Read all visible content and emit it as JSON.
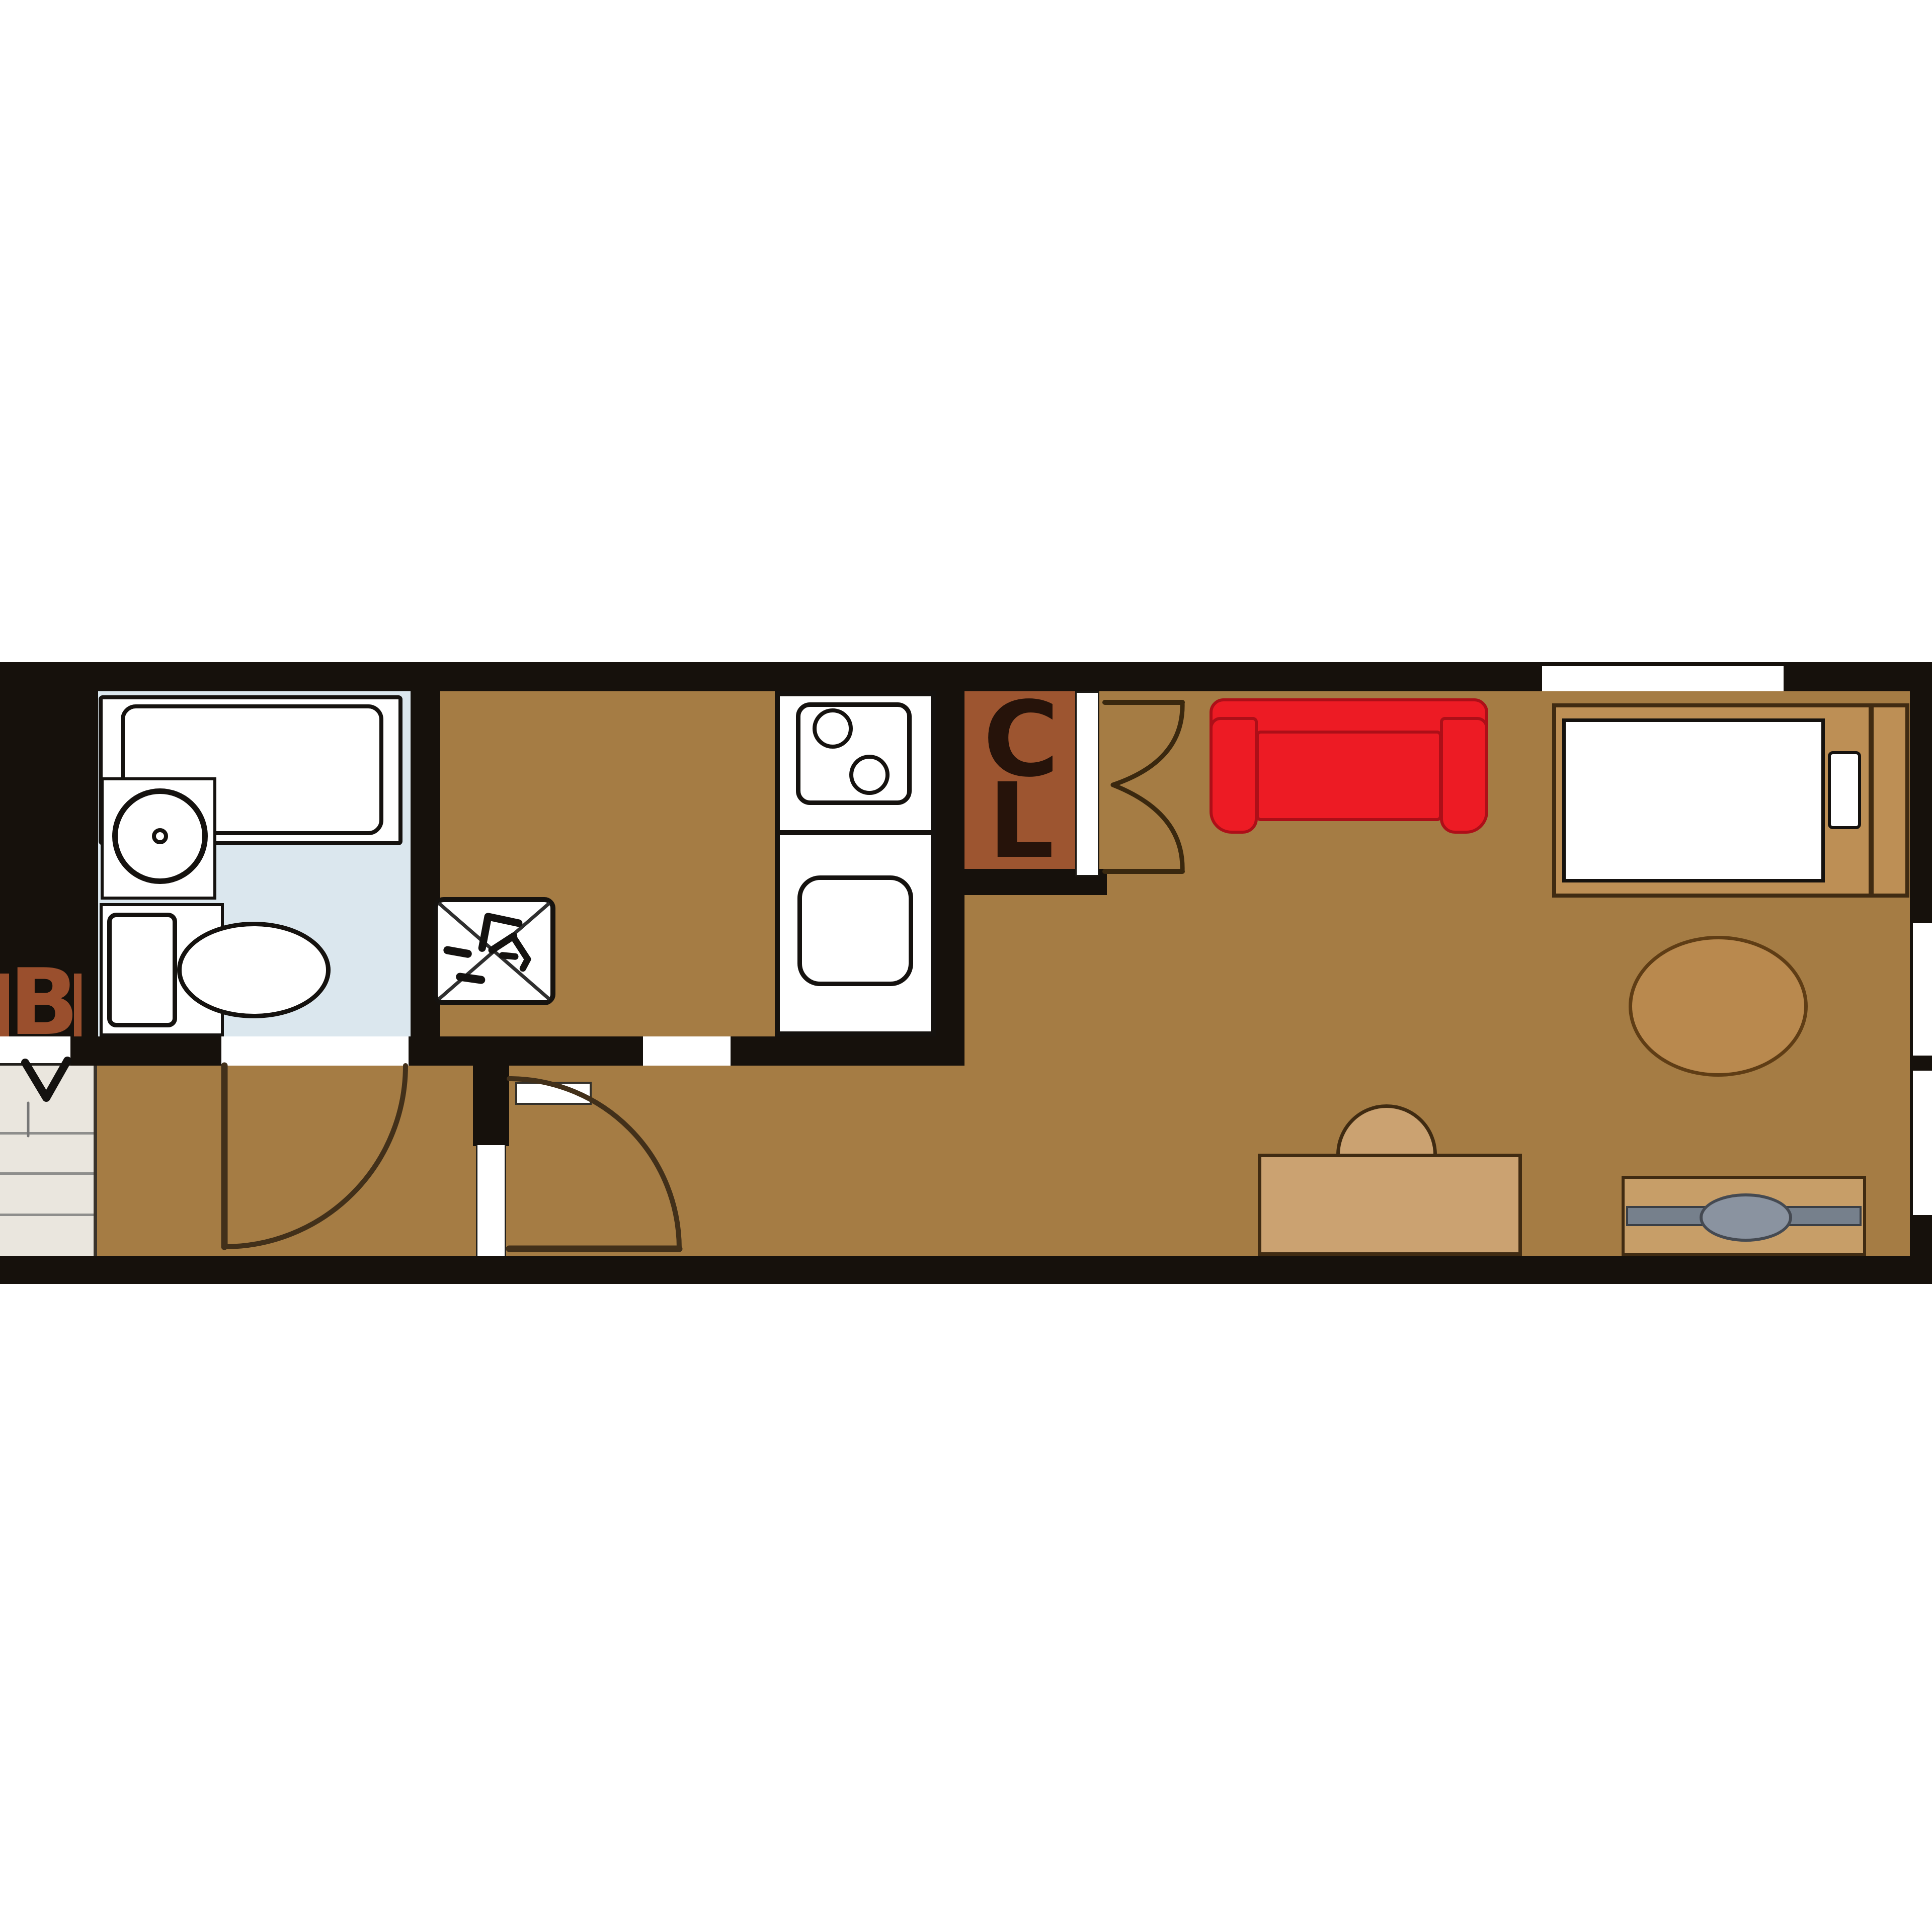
{
  "title": "narrow-studio-apartment-floor-plan",
  "labels": {
    "bath_label": "B",
    "closet_letter_top": "C",
    "closet_letter_bottom": "L"
  },
  "icons": {
    "refrigerator_box": "kanji-rei-refrigerator-icon",
    "refrigerator_cross": "x-crossbox-icon",
    "entry_arrow": "door-swing-arrow-icon",
    "bifold_doors": "closet-bifold-door-arcs-icon",
    "door_swings": "quarter-circle-door-swing-icon"
  },
  "colors": {
    "wall": "#16110c",
    "floor": "#a57c44",
    "bath-floor": "#dbe7ee",
    "stairs": "#eae6de",
    "stair-line": "#8e8e8c",
    "closet": "#9d5530",
    "closet-letter": "#26130a",
    "label-b": "#9a4f2d",
    "couch": "#ed1b24",
    "couch-edge": "#ad0f18",
    "bed-frame": "#bd8f55",
    "furn-edge": "#402b12",
    "desk": "#cba271",
    "stand": "#c79e68",
    "oval": "#b9894e",
    "oval-edge": "#5f3d15",
    "tv-bar": "#76808c",
    "tv-bar-edge": "#3a3f46",
    "tv-screen": "#8a93a0",
    "tv-screen-edge": "#454a52",
    "fixture-edge": "#15120f",
    "arc": "#42301a"
  }
}
